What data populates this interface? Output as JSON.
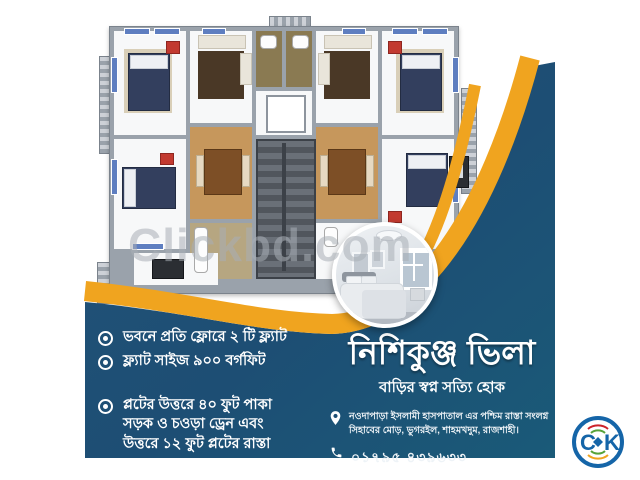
{
  "watermark": {
    "text": "Clickbd.com"
  },
  "features": {
    "items": [
      {
        "text": "ভবনে প্রতি ফ্লোরে ২ টি ফ্ল্যাট"
      },
      {
        "text": "ফ্ল্যাট সাইজ ৯০০ বর্গফিট"
      },
      {
        "text": "প্লটের উত্তরে ৪০ ফুট পাকা\nসড়ক ও চওড়া ড্রেন এবং\nউত্তরে ১২ ফুট প্লটের রাস্তা"
      }
    ]
  },
  "brand": {
    "title": "নিশিকুঞ্জ ভিলা",
    "tagline": "বাড়ির স্বপ্ন সত্যি হোক"
  },
  "contact": {
    "address": "নওদাপাড়া ইসলামী হাসপাতাল এর পশ্চিম রাস্তা সংলগ্ন\nসিহাবের মোড়, ভুগরইল, শাহমখদুম, রাজশাহী।",
    "phone": "০১৭৯৫ ৪৩৯৬৩৩"
  },
  "logo": {
    "c": "C",
    "k": "K"
  },
  "colors": {
    "primary_blue": "#1d4e74",
    "accent_yellow": "#f0a41f",
    "text_white": "#ffffff"
  },
  "icons": {
    "feature_bullet": "fisheye-bullet-icon",
    "address": "location-pin-icon",
    "phone": "telephone-icon",
    "logo": "clickbd-logo"
  }
}
